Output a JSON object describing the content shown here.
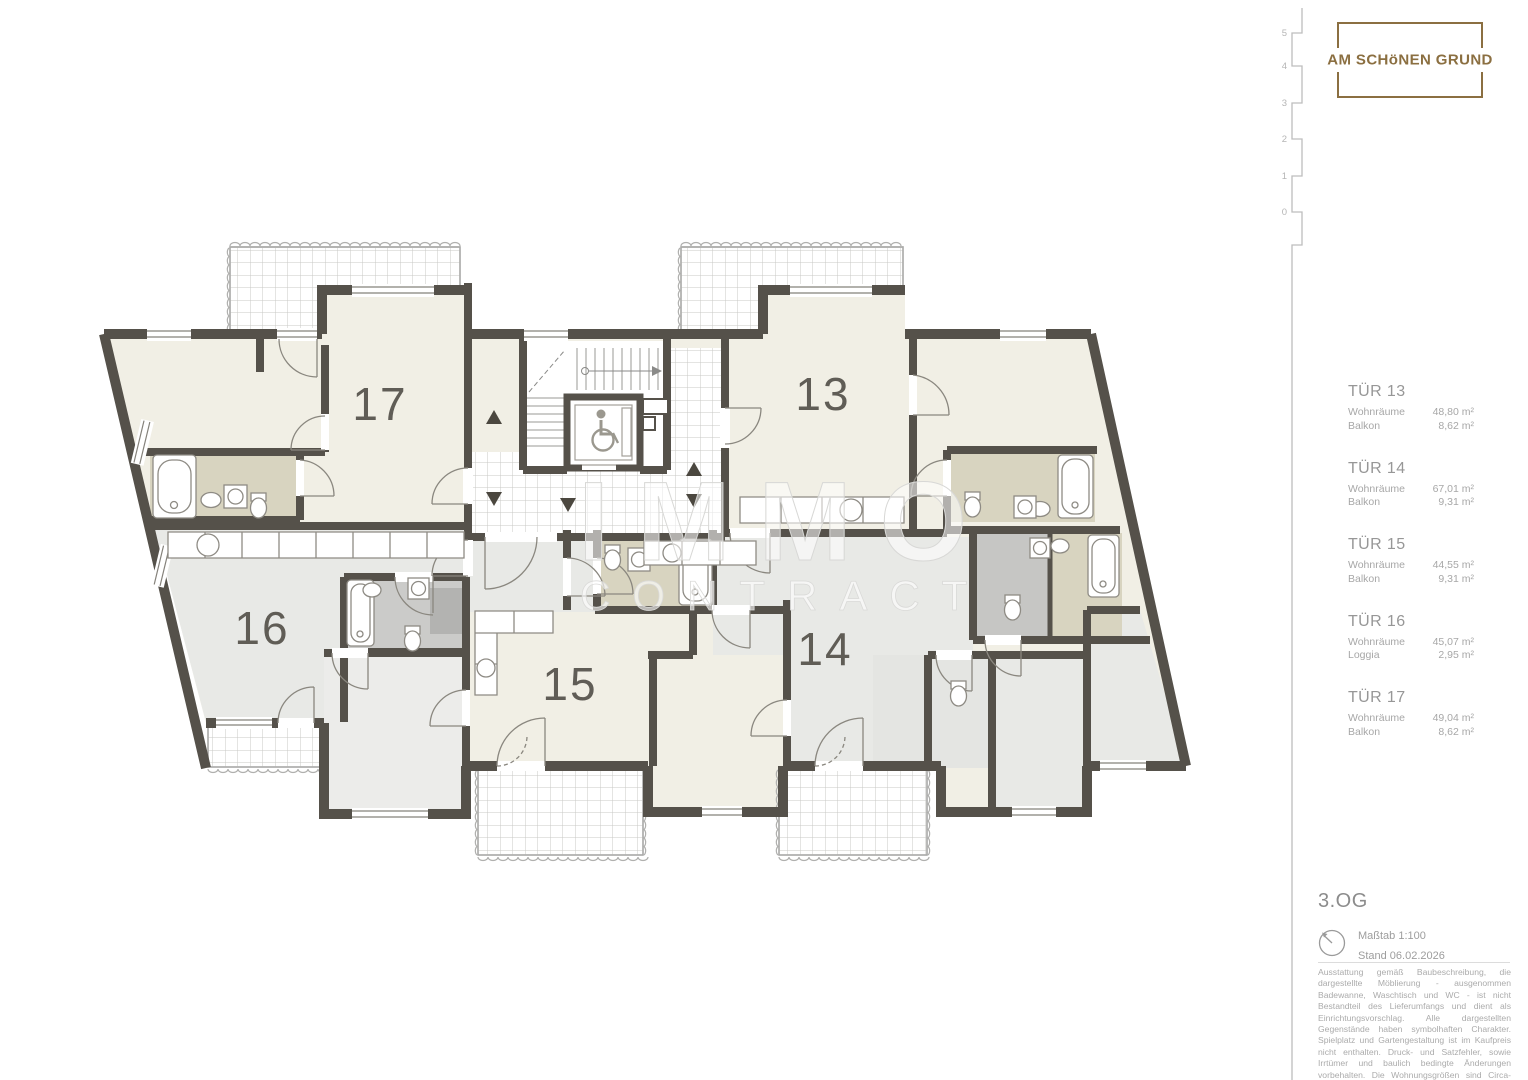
{
  "branding": {
    "logo_text": "AM SCHöNEN GRUND"
  },
  "floor_indicator": {
    "levels": [
      "5",
      "4",
      "3",
      "2",
      "1",
      "0"
    ]
  },
  "apartments": [
    {
      "id": "TÜR 13",
      "rows": [
        {
          "label": "Wohnräume",
          "value": "48,80 m²"
        },
        {
          "label": "Balkon",
          "value": "8,62 m²"
        }
      ]
    },
    {
      "id": "TÜR 14",
      "rows": [
        {
          "label": "Wohnräume",
          "value": "67,01 m²"
        },
        {
          "label": "Balkon",
          "value": "9,31 m²"
        }
      ]
    },
    {
      "id": "TÜR 15",
      "rows": [
        {
          "label": "Wohnräume",
          "value": "44,55 m²"
        },
        {
          "label": "Balkon",
          "value": "9,31 m²"
        }
      ]
    },
    {
      "id": "TÜR 16",
      "rows": [
        {
          "label": "Wohnräume",
          "value": "45,07 m²"
        },
        {
          "label": "Loggia",
          "value": "2,95 m²"
        }
      ]
    },
    {
      "id": "TÜR 17",
      "rows": [
        {
          "label": "Wohnräume",
          "value": "49,04 m²"
        },
        {
          "label": "Balkon",
          "value": "8,62 m²"
        }
      ]
    }
  ],
  "plan": {
    "rooms": [
      {
        "number": "17"
      },
      {
        "number": "13"
      },
      {
        "number": "16"
      },
      {
        "number": "15"
      },
      {
        "number": "14"
      }
    ],
    "watermark": {
      "line1": "IMMO",
      "line2": "CONTRACT"
    }
  },
  "footer": {
    "floor_label": "3.OG",
    "scale": "Maßtab 1:100",
    "date": "Stand 06.02.2026",
    "disclaimer": "Ausstattung gemäß Baubeschreibung, die dargestellte Möblierung - ausgenommen Badewanne, Waschtisch und WC - ist nicht Bestandteil des Lieferumfangs und dient als Einrichtungsvorschlag. Alle dargestellten Gegenstände haben symbolhaften Charakter. Spielplatz und Gartengestaltung ist im Kaufpreis nicht enthalten. Druck- und Satzfehler, sowie Irrtümer und baulich bedingte Änderungen vorbehalten. Die Wohnungsgrößen sind Circa-Angaben und können sich durch die Detailplanung geringfügig ändern. Maßgeblich ist in jedem Fall der Kaufvertrag."
  },
  "colors": {
    "accent_brown": "#8b6f41",
    "wall": "#55514a",
    "room_cream": "#f1efe5",
    "room_gray": "#e8e9e6",
    "bath_tan": "#d8d4c0",
    "bath_gray": "#cbcbc9"
  }
}
